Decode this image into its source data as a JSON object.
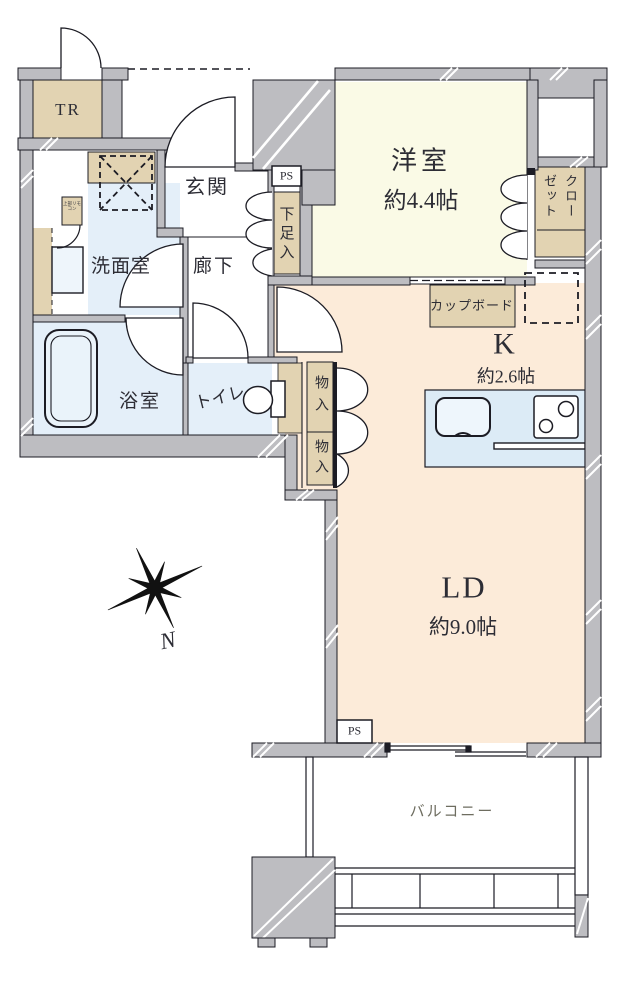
{
  "floorplan": {
    "rooms": {
      "trunk_room": {
        "label": "TR"
      },
      "entrance": {
        "label": "玄関"
      },
      "western_room": {
        "label": "洋室",
        "size": "約4.4帖"
      },
      "closet": {
        "label": "クローゼット"
      },
      "shoe_cabinet": {
        "label": "下足入"
      },
      "pipe_space_top": {
        "label": "PS"
      },
      "washroom": {
        "label": "洗面室"
      },
      "hallway": {
        "label": "廊下"
      },
      "bathroom": {
        "label": "浴室"
      },
      "toilet": {
        "label": "トイレ"
      },
      "storage_upper": {
        "label": "物入"
      },
      "storage_lower": {
        "label": "物入"
      },
      "cupboard": {
        "label": "カップボード"
      },
      "kitchen": {
        "label": "K",
        "size": "約2.6帖"
      },
      "living_dining": {
        "label": "LD",
        "size": "約9.0帖"
      },
      "pipe_space_bottom": {
        "label": "PS"
      },
      "balcony": {
        "label": "バルコニー"
      }
    },
    "annotations": {
      "north_mark": "N",
      "water_heater_note": "上部リモコン"
    },
    "icons": {
      "compass_icon": "eight-point compass star",
      "bathtub_icon": "bathtub outline",
      "toilet_icon": "toilet bowl and tank",
      "sink_icon": "kitchen sink",
      "stove_icon": "two-burner stove",
      "washer_space_icon": "dashed box with X (washing machine space)",
      "fridge_space_icon": "dashed box (refrigerator space)"
    },
    "colors": {
      "wall_gray": "#bdbdc1",
      "fixture_beige": "#e2d3b2",
      "western_room_yellow": "#fafae6",
      "ldk_peach": "#fcebd9",
      "sanitary_blue": "#e4eff9",
      "counter_blue": "#dcebf6",
      "line_black": "#1c1c24",
      "balcony_text": "#6e6d60"
    }
  }
}
